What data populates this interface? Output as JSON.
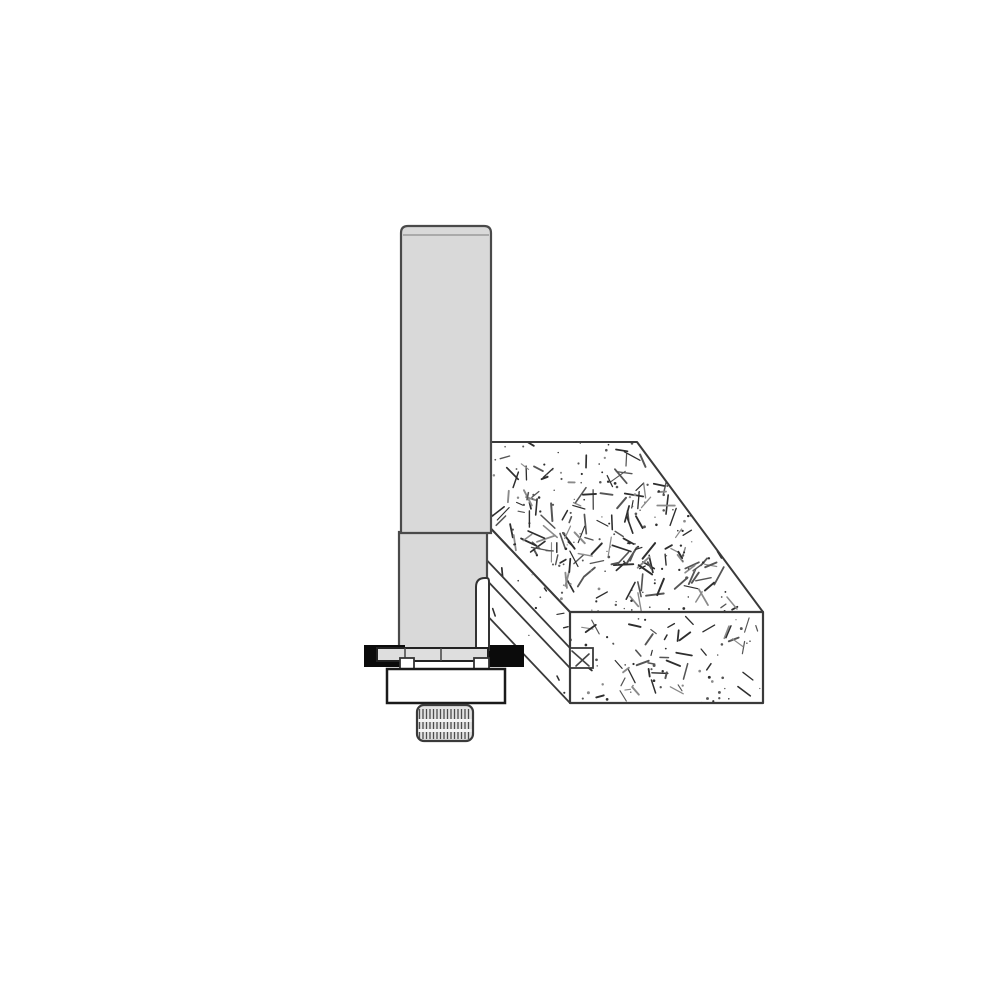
{
  "figure": {
    "title": "slot-cutter-router-bit-grooving-particleboard-edge",
    "background": "#ffffff",
    "palette": {
      "steel_fill": "#d9d9d9",
      "steel_stroke": "#4a4a4a",
      "blade_fill": "#dedede",
      "blade_stroke": "#222222",
      "carbide_black": "#0b0b0b",
      "bearing_fill": "#ffffff",
      "bearing_stroke": "#1a1a1a",
      "nut_fill": "#e3e3e3",
      "nut_stroke": "#3a3a3a",
      "knurl_line": "#4d4d4d",
      "wood_outline": "#3a3a3a",
      "speckle_dark": "#2e2e2e",
      "speckle_mid": "#555555",
      "speckle_light": "#8a8a8a",
      "groove_fill": "#ffffff"
    },
    "components": [
      {
        "name": "bit-shank",
        "kind": "cylindrical shank",
        "color": "#d9d9d9"
      },
      {
        "name": "bit-arbor",
        "kind": "arbor below shank step",
        "color": "#d9d9d9"
      },
      {
        "name": "cutter-blade-bar",
        "kind": "slot cutter body",
        "color": "#dedede"
      },
      {
        "name": "cutter-wing-left",
        "kind": "carbide cutting wing",
        "color": "#0b0b0b"
      },
      {
        "name": "cutter-wing-right",
        "kind": "carbide cutting wing engaged in groove",
        "color": "#0b0b0b"
      },
      {
        "name": "cutter-wing-upper",
        "kind": "upward sweeping wing",
        "color": "#ffffff"
      },
      {
        "name": "spacer-tabs",
        "kind": "washer tabs",
        "color": "#ffffff"
      },
      {
        "name": "pilot-bearing",
        "kind": "guide bearing",
        "color": "#ffffff"
      },
      {
        "name": "retaining-nut",
        "kind": "knurled retaining nut",
        "color": "#e3e3e3"
      },
      {
        "name": "workpiece",
        "kind": "particleboard block with edge groove",
        "color": "#ffffff"
      }
    ],
    "geometry": {
      "shank": {
        "x": 401,
        "y": 226,
        "w": 90,
        "h": 307,
        "rtop": 7
      },
      "shank_chamfer_y": 235,
      "arbor": {
        "x": 399,
        "y": 532,
        "w": 88,
        "h": 118
      },
      "wing_upper": {
        "x": 476,
        "y": 578,
        "w": 13,
        "h": 72
      },
      "blade_bar": {
        "x": 377,
        "y": 648,
        "w": 111,
        "h": 13,
        "dividers": [
          405,
          441
        ]
      },
      "wing_left": {
        "x": 364,
        "y": 645,
        "w": 41,
        "h": 22
      },
      "wing_right": {
        "x": 488,
        "y": 645,
        "w": 36,
        "h": 22
      },
      "tabs": [
        {
          "x": 400,
          "y": 658,
          "w": 14,
          "h": 12
        },
        {
          "x": 474,
          "y": 658,
          "w": 15,
          "h": 12
        }
      ],
      "bearing": {
        "x": 387,
        "y": 669,
        "w": 118,
        "h": 34
      },
      "nut": {
        "x": 417,
        "y": 705,
        "w": 56,
        "h": 36,
        "r": 7,
        "knurl_step": 3.5,
        "bands_y": [
          719,
          729
        ]
      },
      "wood": {
        "top_face": [
          [
            480,
            442
          ],
          [
            637,
            442
          ],
          [
            763,
            612
          ],
          [
            570,
            612
          ],
          [
            480,
            517
          ]
        ],
        "edge_face": [
          [
            480,
            517
          ],
          [
            570,
            612
          ],
          [
            570,
            703
          ],
          [
            480,
            608
          ]
        ],
        "groove_strip": [
          [
            480,
            553
          ],
          [
            570,
            648
          ],
          [
            570,
            668
          ],
          [
            480,
            573
          ]
        ],
        "end_face": {
          "x": 570,
          "y": 612,
          "w": 193,
          "h": 91
        },
        "notch": {
          "x": 570,
          "y": 648,
          "w": 23,
          "h": 20
        },
        "notch_marks": [
          [
            572,
            651,
            589,
            666
          ],
          [
            576,
            666,
            589,
            654
          ]
        ]
      },
      "speckle": {
        "seed": 7,
        "top_face": {
          "segments": 150,
          "dots": 130,
          "len_min": 6,
          "len_max": 20
        },
        "end_face": {
          "segments": 46,
          "dots": 42,
          "len_min": 5,
          "len_max": 16
        },
        "edge_face": {
          "segments": 12,
          "dots": 10,
          "len_min": 3,
          "len_max": 9
        }
      }
    }
  }
}
